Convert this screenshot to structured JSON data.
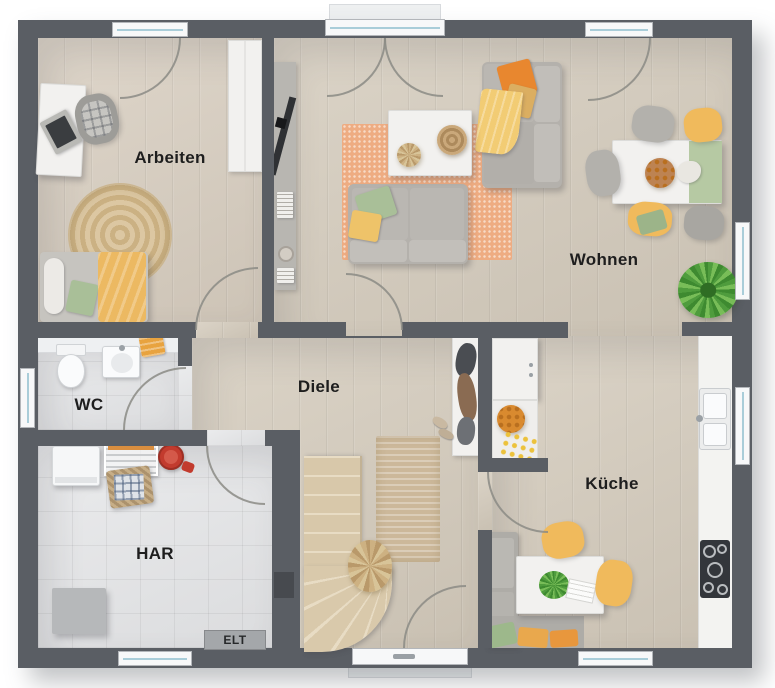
{
  "floorplan": {
    "rooms": {
      "arbeiten": {
        "label": "Arbeiten"
      },
      "wohnen": {
        "label": "Wohnen"
      },
      "diele": {
        "label": "Diele"
      },
      "wc": {
        "label": "WC"
      },
      "har": {
        "label": "HAR"
      },
      "kueche": {
        "label": "Küche"
      },
      "elt": {
        "label": "ELT"
      }
    },
    "colors": {
      "wall": "#5a5e64",
      "wood_floor": "#d4cbbc",
      "tile_floor": "#e4e5e7",
      "rug_orange": "#eeac82",
      "rug_jute": "#cbb183",
      "accent_yellow": "#f0ba5c",
      "accent_orange": "#e8872f",
      "accent_green": "#a9bf98",
      "window_glass": "#a9cdd9",
      "background": "#ffffff"
    }
  }
}
